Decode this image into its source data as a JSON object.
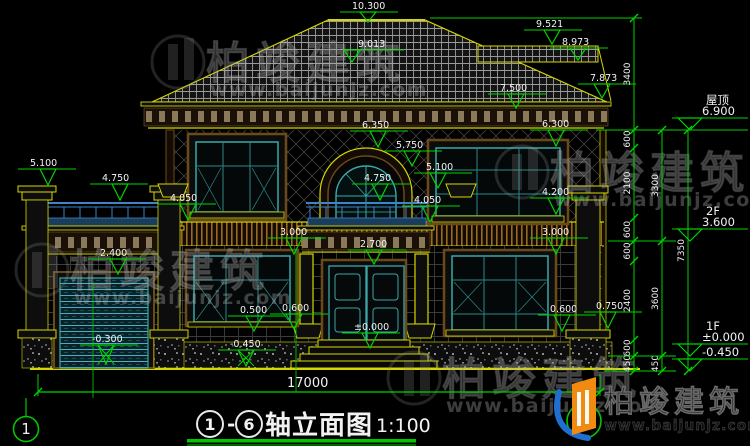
{
  "title": {
    "axis_from": "1",
    "dash": "-",
    "axis_to": "6",
    "name": "轴立面图",
    "scale": "1:100"
  },
  "axes": {
    "left_bubble": "1",
    "right_bubble": "6"
  },
  "right_levels": [
    {
      "label": "屋顶",
      "value": "6.900",
      "y": 130
    },
    {
      "label": "2F",
      "value": "3.600",
      "y": 241
    },
    {
      "label": "1F",
      "value": "±0.000",
      "y": 356
    },
    {
      "label": "",
      "value": "-0.450",
      "y": 371
    }
  ],
  "elevation_markers": [
    {
      "v": "10.300",
      "tx": 352,
      "ty": 9,
      "mx": 368,
      "my": 22
    },
    {
      "v": "9.013",
      "tx": 358,
      "ty": 47,
      "mx": 352,
      "my": 62
    },
    {
      "v": "9.521",
      "tx": 536,
      "ty": 27,
      "mx": 552,
      "my": 44
    },
    {
      "v": "8.973",
      "tx": 562,
      "ty": 45,
      "mx": 578,
      "my": 60
    },
    {
      "v": "7.873",
      "tx": 590,
      "ty": 81,
      "mx": 602,
      "my": 98
    },
    {
      "v": "7.500",
      "tx": 500,
      "ty": 91,
      "mx": 516,
      "my": 108
    },
    {
      "v": "6.350",
      "tx": 362,
      "ty": 128,
      "mx": 378,
      "my": 147
    },
    {
      "v": "5.750",
      "tx": 396,
      "ty": 148,
      "mx": 412,
      "my": 166
    },
    {
      "v": "5.100",
      "tx": 426,
      "ty": 170,
      "mx": 438,
      "my": 188
    },
    {
      "v": "4.750",
      "tx": 364,
      "ty": 181,
      "mx": 380,
      "my": 200
    },
    {
      "v": "4.050",
      "tx": 414,
      "ty": 203,
      "mx": 430,
      "my": 222
    },
    {
      "v": "5.100",
      "tx": 30,
      "ty": 166,
      "mx": 48,
      "my": 185
    },
    {
      "v": "4.750",
      "tx": 102,
      "ty": 181,
      "mx": 120,
      "my": 200
    },
    {
      "v": "4.050",
      "tx": 170,
      "ty": 201,
      "mx": 188,
      "my": 220
    },
    {
      "v": "2.400",
      "tx": 100,
      "ty": 256,
      "mx": 118,
      "my": 274
    },
    {
      "v": "-0.300",
      "tx": 92,
      "ty": 342,
      "mx": 106,
      "my": 364,
      "kind": "cross"
    },
    {
      "v": "2.700",
      "tx": 360,
      "ty": 247,
      "mx": 374,
      "my": 264
    },
    {
      "v": "±0.000",
      "tx": 354,
      "ty": 330,
      "mx": 370,
      "my": 348
    },
    {
      "v": "-0.450",
      "tx": 230,
      "ty": 347,
      "mx": 246,
      "my": 366,
      "kind": "cross"
    },
    {
      "v": "0.500",
      "tx": 240,
      "ty": 313,
      "mx": 254,
      "my": 331
    },
    {
      "v": "0.600",
      "tx": 282,
      "ty": 311,
      "mx": 294,
      "my": 329
    },
    {
      "v": "6.300",
      "tx": 542,
      "ty": 127,
      "mx": 556,
      "my": 146
    },
    {
      "v": "4.200",
      "tx": 542,
      "ty": 195,
      "mx": 556,
      "my": 214
    },
    {
      "v": "3.000",
      "tx": 280,
      "ty": 235,
      "mx": 294,
      "my": 254
    },
    {
      "v": "3.000",
      "tx": 542,
      "ty": 235,
      "mx": 556,
      "my": 254
    },
    {
      "v": "0.600",
      "tx": 550,
      "ty": 312,
      "mx": 562,
      "my": 331
    },
    {
      "v": "0.750",
      "tx": 596,
      "ty": 309,
      "mx": 608,
      "my": 328
    }
  ],
  "dim_chains": [
    {
      "x": 634,
      "segments": [
        {
          "y1": 18,
          "y2": 130,
          "label": "3400"
        },
        {
          "y1": 130,
          "y2": 148,
          "label": "600"
        },
        {
          "y1": 148,
          "y2": 218,
          "label": "2100"
        },
        {
          "y1": 218,
          "y2": 241,
          "label": "600"
        },
        {
          "y1": 241,
          "y2": 261,
          "label": "600"
        },
        {
          "y1": 261,
          "y2": 340,
          "label": "2400"
        },
        {
          "y1": 340,
          "y2": 356,
          "label": "600"
        },
        {
          "y1": 356,
          "y2": 371,
          "label": "450"
        }
      ]
    },
    {
      "x": 662,
      "segments": [
        {
          "y1": 130,
          "y2": 241,
          "label": "3300"
        },
        {
          "y1": 241,
          "y2": 356,
          "label": "3600"
        },
        {
          "y1": 356,
          "y2": 371,
          "label": "450"
        }
      ]
    },
    {
      "x": 688,
      "segments": [
        {
          "y1": 130,
          "y2": 371,
          "label": "7350"
        }
      ]
    }
  ],
  "h_guides": [
    {
      "x1": 430,
      "y": 18,
      "x2": 642
    },
    {
      "x1": 596,
      "y": 130,
      "x2": 748
    },
    {
      "x1": 608,
      "y": 241,
      "x2": 676
    },
    {
      "x1": 608,
      "y": 356,
      "x2": 676
    },
    {
      "x1": 604,
      "y": 371,
      "x2": 676
    }
  ],
  "total_dim": {
    "label": "17000",
    "y": 392,
    "x1": 38,
    "x2": 600,
    "tx": 287,
    "ty": 387
  },
  "watermark": {
    "brand": "柏竣建筑",
    "url": "www.baijunjz.com",
    "spots": [
      {
        "x": 158,
        "y": 28
      },
      {
        "x": 502,
        "y": 138
      },
      {
        "x": 22,
        "y": 236
      },
      {
        "x": 394,
        "y": 344
      }
    ]
  },
  "logo": {
    "brand": "柏竣建筑",
    "url": "www.baijunjz.com"
  },
  "colors": {
    "dim_green": "#00d400",
    "axis_green": "#00c800",
    "outline_yellow": "#d6d600",
    "window_teal": "#3aa8a8",
    "railing_blue": "#3d85c8",
    "surround_brown": "#6b4a1a",
    "text_white": "#f2f2f2"
  }
}
